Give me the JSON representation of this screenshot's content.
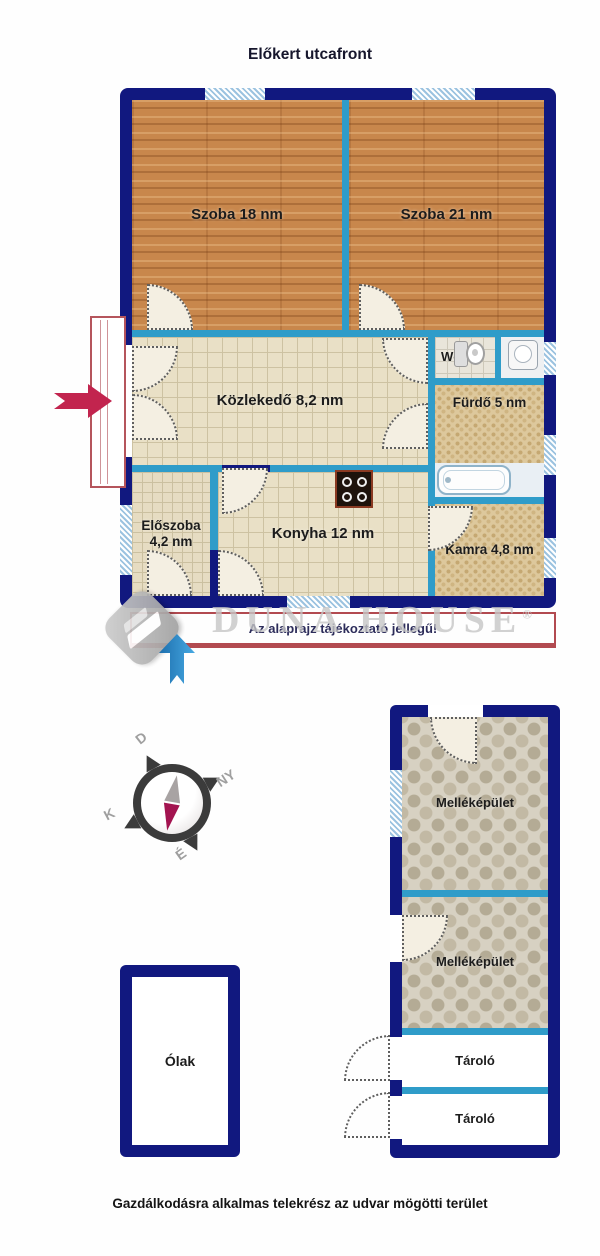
{
  "texts": {
    "title": "Előkert utcafront",
    "disclaimer": "Az alaprajz tájékoztató jellegű!",
    "footer": "Gazdálkodásra alkalmas telekrész az udvar mögötti terület"
  },
  "watermark": {
    "text": "DUNA HOUSE",
    "reg": "®"
  },
  "compass": {
    "d": "D",
    "ny": "NY",
    "k": "K",
    "e": "É"
  },
  "rooms": {
    "szoba18": "Szoba 18 nm",
    "szoba21": "Szoba 21 nm",
    "kozlekedo": "Közlekedő 8,2 nm",
    "wc": "Wc",
    "furdo": "Fürdő 5 nm",
    "eloszoba_line1": "Előszoba",
    "eloszoba_line2": "4,2 nm",
    "konyha": "Konyha 12 nm",
    "kamra": "Kamra 4,8 nm",
    "mellekepulet1": "Melléképület",
    "mellekepulet2": "Melléképület",
    "tarolo1": "Tároló",
    "tarolo2": "Tároló",
    "olak": "Ólak"
  },
  "colors": {
    "wall": "#11187f",
    "interior_wall": "#2f9cc9",
    "window": "#cfe3f2",
    "annotation_red": "#b24a50",
    "entrance_arrow_red": "#c2244e",
    "entrance_arrow_blue": "#2e8fd0",
    "watermark_gray": "#c6c6c6"
  }
}
